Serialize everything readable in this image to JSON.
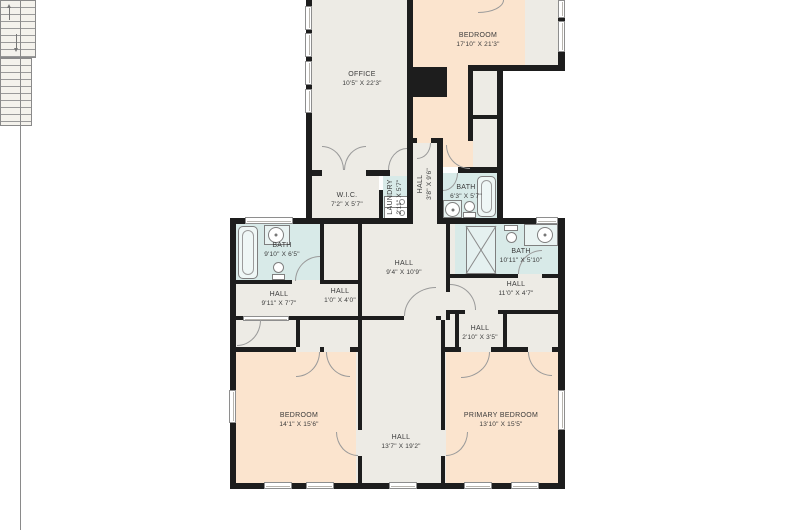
{
  "floor_plan": {
    "rooms": {
      "office": {
        "name": "OFFICE",
        "dims": "10'5\" X 22'3\""
      },
      "bedroom_top": {
        "name": "BEDROOM",
        "dims": "17'10\" X 21'3\""
      },
      "wic": {
        "name": "W.I.C.",
        "dims": "7'2\" X 5'7\""
      },
      "laundry": {
        "name": "LAUNDRY",
        "dims": "2'11\" X 5'7\""
      },
      "hall_upper": {
        "name": "HALL",
        "dims": "3'8\" X 9'6\""
      },
      "bath_upper": {
        "name": "BATH",
        "dims": "6'3\" X 5'7\""
      },
      "bath_left": {
        "name": "BATH",
        "dims": "9'10\" X 6'5\""
      },
      "hall_center": {
        "name": "HALL",
        "dims": "9'4\" X 10'9\""
      },
      "bath_right": {
        "name": "BATH",
        "dims": "10'11\" X 5'10\""
      },
      "hall_left": {
        "name": "HALL",
        "dims": "9'11\" X 7'7\""
      },
      "hall_small": {
        "name": "HALL",
        "dims": "1'0\" X 4'0\""
      },
      "hall_right": {
        "name": "HALL",
        "dims": "11'0\" X 4'7\""
      },
      "hall_vestibule": {
        "name": "HALL",
        "dims": "2'10\" X 3'5\""
      },
      "bedroom_left": {
        "name": "BEDROOM",
        "dims": "14'1\" X 15'6\""
      },
      "hall_lower": {
        "name": "HALL",
        "dims": "13'7\" X 19'2\""
      },
      "primary_bedroom": {
        "name": "PRIMARY BEDROOM",
        "dims": "13'10\" X 15'5\""
      }
    },
    "colors": {
      "bedroom_fill": "#fbe4ce",
      "common_fill": "#edebe5",
      "bath_fill": "#d8eae8",
      "wall": "#1d1d1d",
      "text": "#3b3b3b",
      "background": "#ffffff"
    }
  }
}
